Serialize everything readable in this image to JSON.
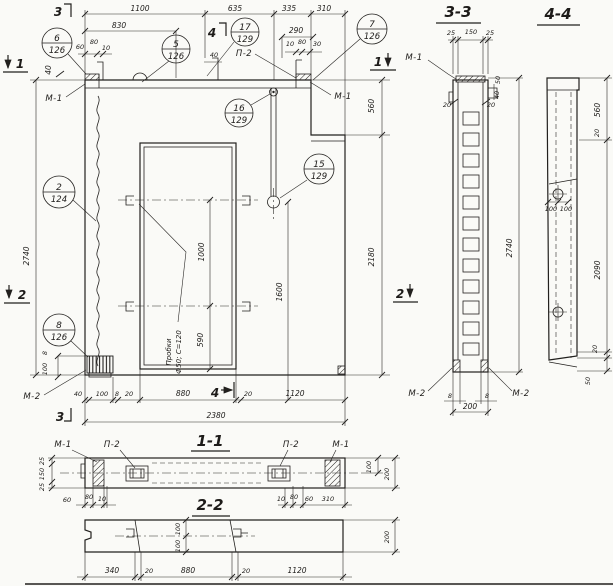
{
  "drawing": {
    "labels": {
      "m1": "М-1",
      "m2": "М-2",
      "p2": "П-2"
    },
    "note_line1": "Пробки",
    "note_line2": "Ф50; С=120",
    "cut_marks": {
      "c1": "1",
      "c2": "2",
      "c3": "3",
      "c4": "4"
    },
    "titles": {
      "s33": "3-3",
      "s44": "4-4",
      "s11": "1-1",
      "s22": "2-2"
    },
    "balloons": {
      "b6": {
        "num": "6",
        "sheet": "126"
      },
      "b5": {
        "num": "5",
        "sheet": "126"
      },
      "b17": {
        "num": "17",
        "sheet": "129"
      },
      "b7": {
        "num": "7",
        "sheet": "126"
      },
      "b16": {
        "num": "16",
        "sheet": "129"
      },
      "b15": {
        "num": "15",
        "sheet": "129"
      },
      "b2": {
        "num": "2",
        "sheet": "124"
      },
      "b8": {
        "num": "8",
        "sheet": "126"
      }
    },
    "dims": {
      "main_top": [
        "1100",
        "635",
        "335",
        "310"
      ],
      "main_top2": [
        "830",
        "290"
      ],
      "main_top3l": [
        "60",
        "80",
        "10"
      ],
      "main_top3m": "40",
      "main_top3r": [
        "10",
        "80",
        "30"
      ],
      "main_left": [
        "40",
        "2740"
      ],
      "main_left_bottom": [
        "8",
        "100"
      ],
      "main_right": [
        "560",
        "2180"
      ],
      "main_inner": [
        "1000",
        "590",
        "1600"
      ],
      "main_bottom": [
        "40",
        "100",
        "8",
        "20",
        "880",
        "20",
        "1120"
      ],
      "main_total": "2380",
      "s33_top": [
        "25",
        "150",
        "25"
      ],
      "s33_right": [
        "50",
        "40"
      ],
      "s33_side": [
        "20",
        "20"
      ],
      "s33_bottom": [
        "8",
        "8",
        "200"
      ],
      "s33_height": "2740",
      "s44_right": [
        "560",
        "20",
        "2090",
        "20",
        "50"
      ],
      "s44_holes": [
        "100",
        "100"
      ],
      "s11_left": [
        "25",
        "150",
        "25"
      ],
      "s11_bl": [
        "60",
        "80",
        "10"
      ],
      "s11_br": [
        "10",
        "80",
        "60",
        "310"
      ],
      "s11_right": [
        "100",
        "200"
      ],
      "s22_bottom": [
        "340",
        "20",
        "880",
        "20",
        "1120"
      ],
      "s22_mid": [
        "100",
        "100"
      ],
      "s22_right": "200"
    }
  }
}
